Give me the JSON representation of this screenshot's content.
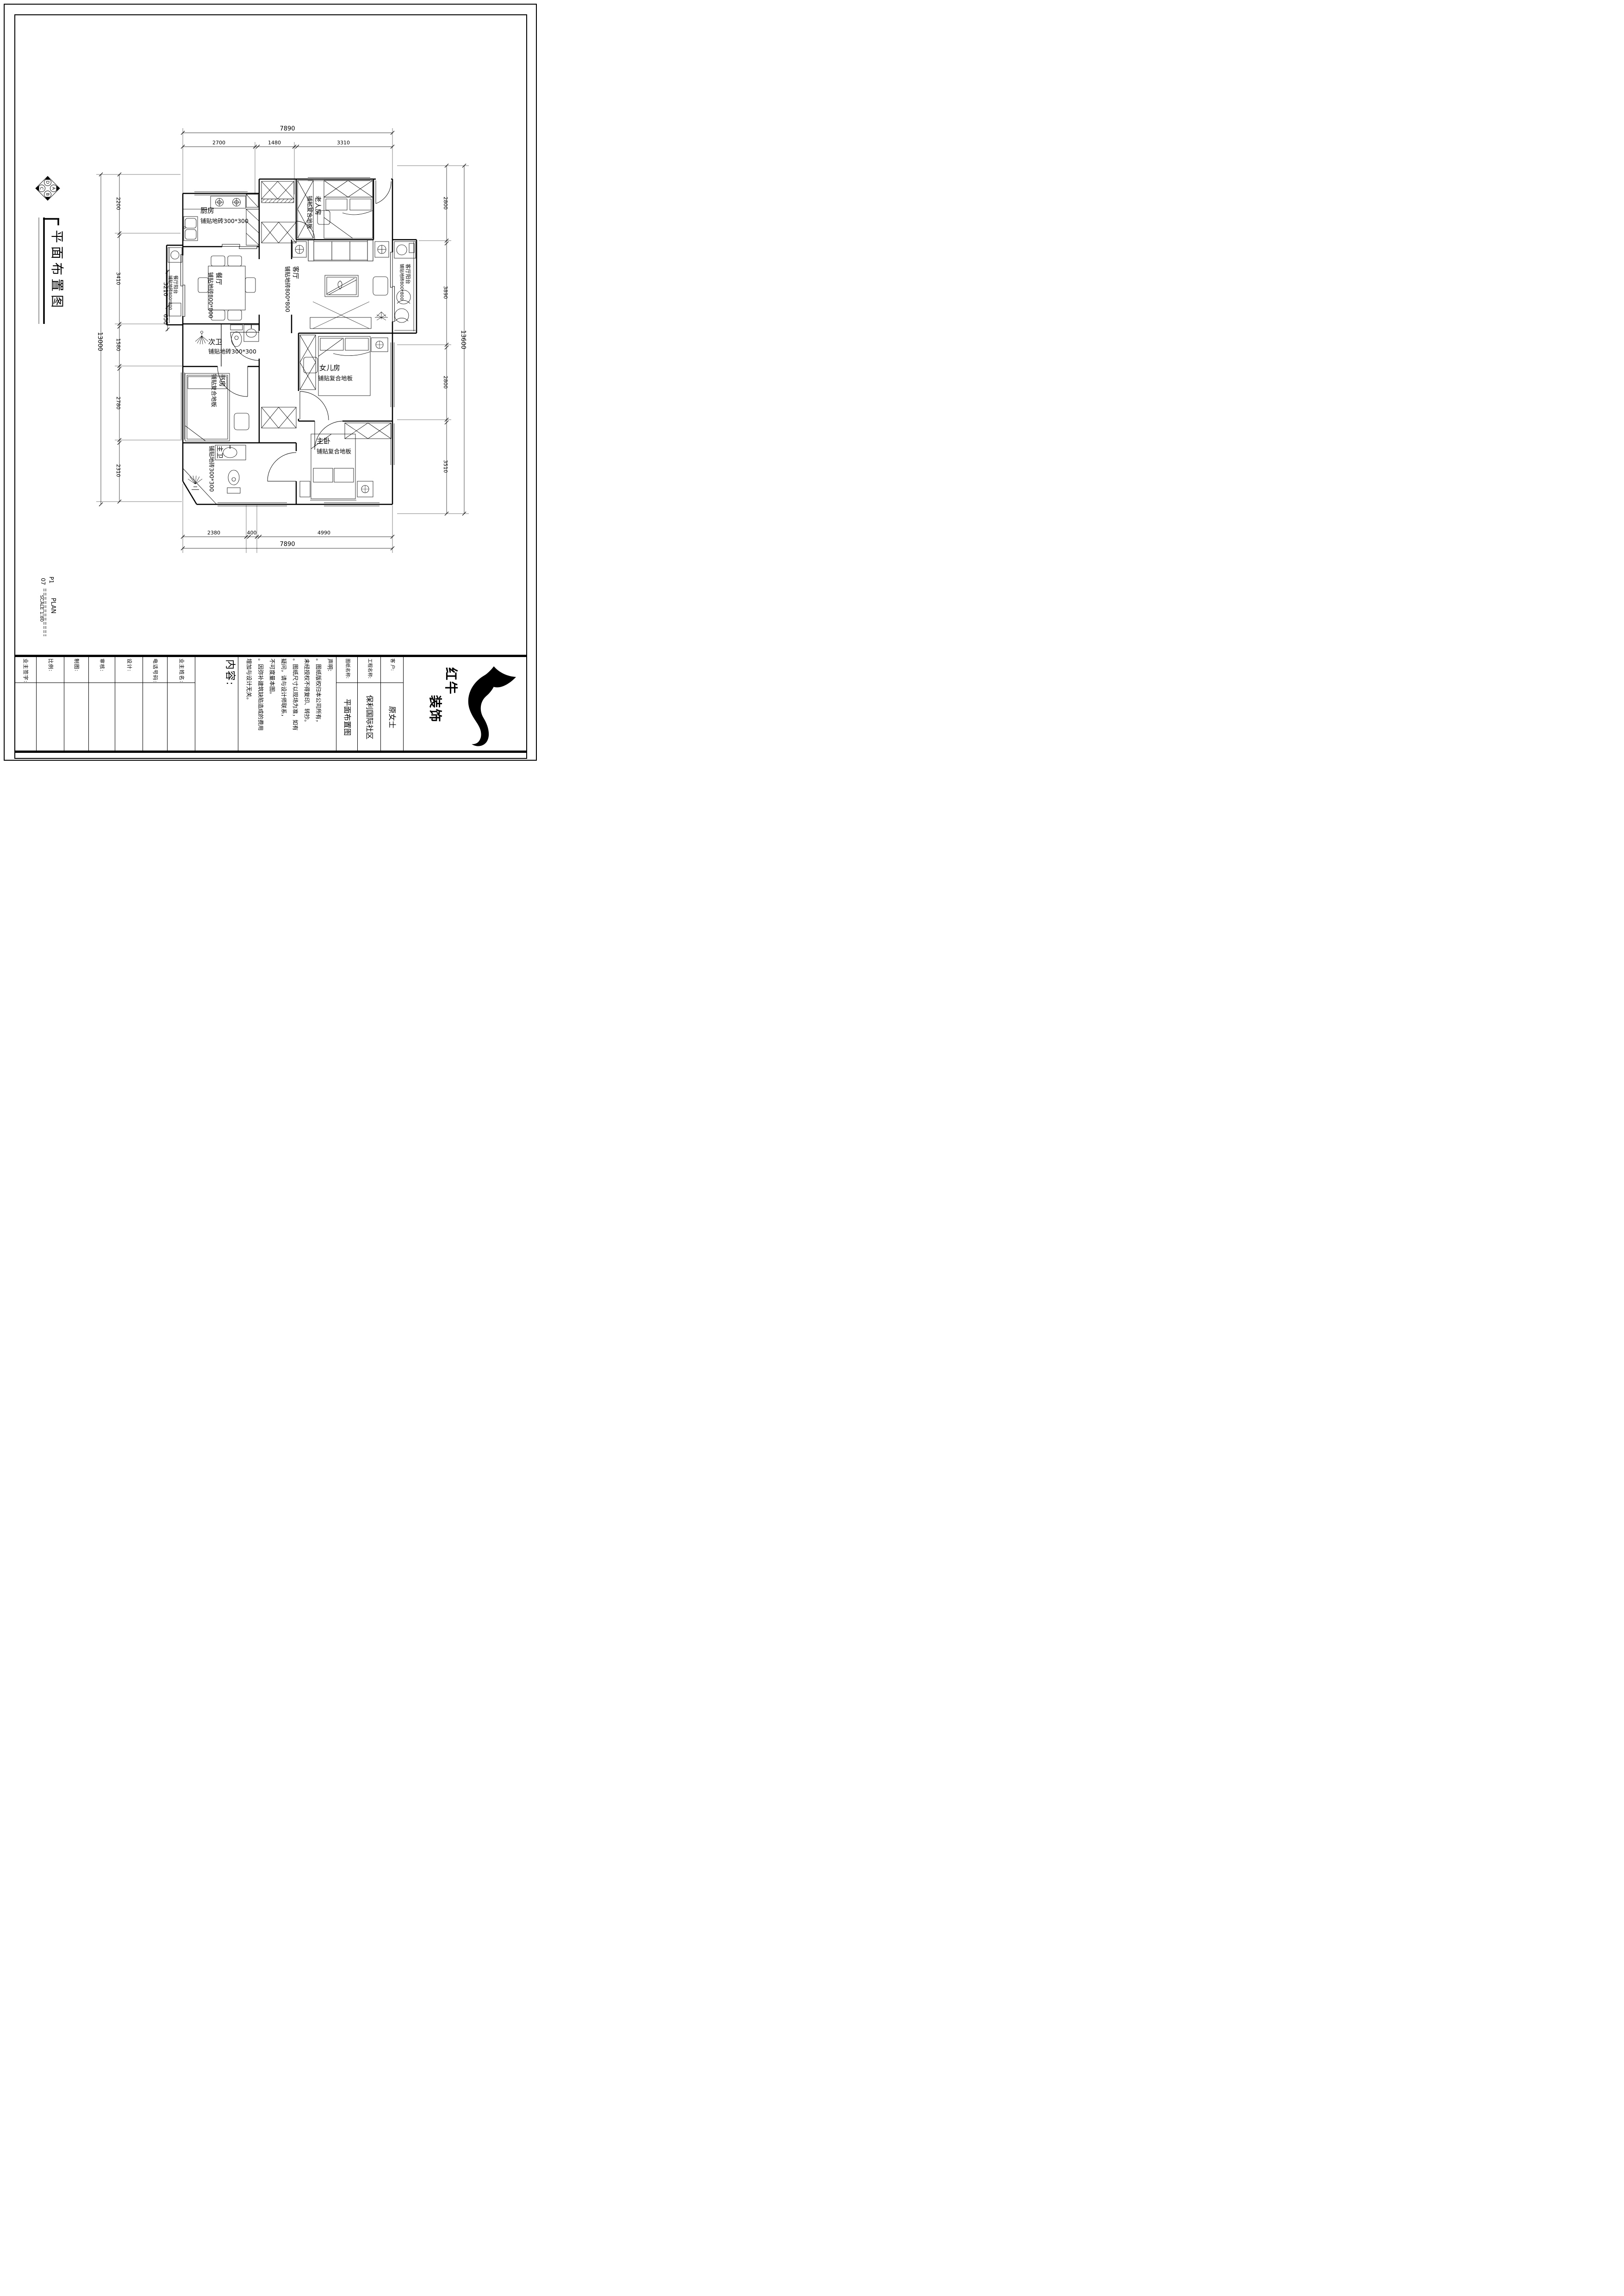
{
  "sheet": {
    "drawing_title": "平面布置图",
    "sheet_code": "P1",
    "sheet_no": "07",
    "plan_word": "PLAN",
    "scale_word": "SCALE 1:80",
    "compass": {
      "top": "D",
      "right": "A",
      "bottom": "B",
      "left": "C"
    }
  },
  "rooms": {
    "kitchen": {
      "name": "厨房",
      "spec": "铺贴地砖300*300"
    },
    "elder": {
      "name": "老人房",
      "spec": "铺贴复合地板"
    },
    "living": {
      "name": "客厅",
      "spec": "铺贴地砖800*800"
    },
    "dining": {
      "name": "餐厅",
      "spec": "铺贴地砖800*800"
    },
    "dining_balcony": {
      "name": "餐厅阳台",
      "spec": "铺贴地砖800*800"
    },
    "living_balcony": {
      "name": "客厅阳台",
      "spec": "铺贴地砖800*800"
    },
    "second_bath": {
      "name": "次卫",
      "spec": "铺贴地砖300*300"
    },
    "study": {
      "name": "书房",
      "spec": "铺贴复合地板"
    },
    "daughter": {
      "name": "女儿房",
      "spec": "铺贴复合地板"
    },
    "master_bath": {
      "name": "主卫",
      "spec": "铺贴地砖300*300"
    },
    "master_bed": {
      "name": "主卧",
      "spec": "铺贴复合地板"
    }
  },
  "dims": {
    "top_total": "7890",
    "top": [
      "2700",
      "1480",
      "3310"
    ],
    "bottom": [
      "2380",
      "400",
      "4990"
    ],
    "bottom_total": "7890",
    "left_total": "13000",
    "left": [
      "2200",
      "3410",
      "1580",
      "2780",
      "2310"
    ],
    "right": [
      "2800",
      "3890",
      "2800",
      "3510"
    ],
    "right_total": "13600",
    "inner": [
      "3210",
      "650"
    ]
  },
  "title_block": {
    "owner_sign": "业主签字:",
    "scale": "比例:",
    "draft": "制图:",
    "review": "审核:",
    "design": "设计:",
    "phone": "电话号码:",
    "owner_name": "业主姓名:",
    "content": "内容:",
    "declaration": "声明:\n。图纸版权归本公司所有，\n未经授权不得复印、转抄。\n。图纸尺寸以现场为准，如有\n疑问，请与设计师联系，\n不可度量本图。\n。因弥补建筑缺陷造成的费用\n增加与设计无关。",
    "drawing_name_label": "图纸名称:",
    "drawing_name": "平面布置图",
    "project_label": "工程名称:",
    "project": "保利国际社区",
    "client_label": "客 户:",
    "client": "原女士",
    "brand": "红牛\n　　装饰"
  }
}
